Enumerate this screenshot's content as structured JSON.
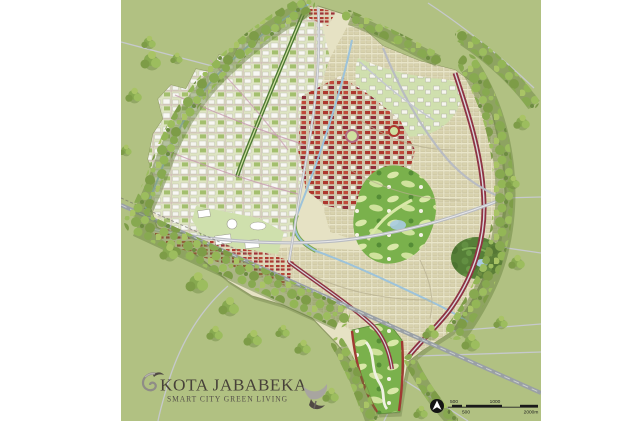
{
  "artwork": {
    "title": "KOTA JABABEKA",
    "subtitle": "SMART CITY GREEN LIVING"
  },
  "scale_bar": {
    "top_labels": [
      "500",
      "1000"
    ],
    "bottom_labels": [
      "0",
      "500",
      "2000m"
    ]
  },
  "icons": {
    "logo": "bird-swirl-icon",
    "flourish": "swoosh-icon",
    "compass": "north-arrow-icon"
  },
  "palette": {
    "page_bg": "#ffffff",
    "map_bg": "#b1c182",
    "tree_green": "#87a950",
    "industrial_block": "#f7f7f1",
    "residential_cream": "#e9e5c8",
    "commercial_red": "#ad372e",
    "corridor_maroon": "#8e3242",
    "golf_green": "#7ab14c",
    "water_blue": "#9dc3da",
    "toll_gray": "#9aa0a5",
    "title_text": "#474139"
  }
}
